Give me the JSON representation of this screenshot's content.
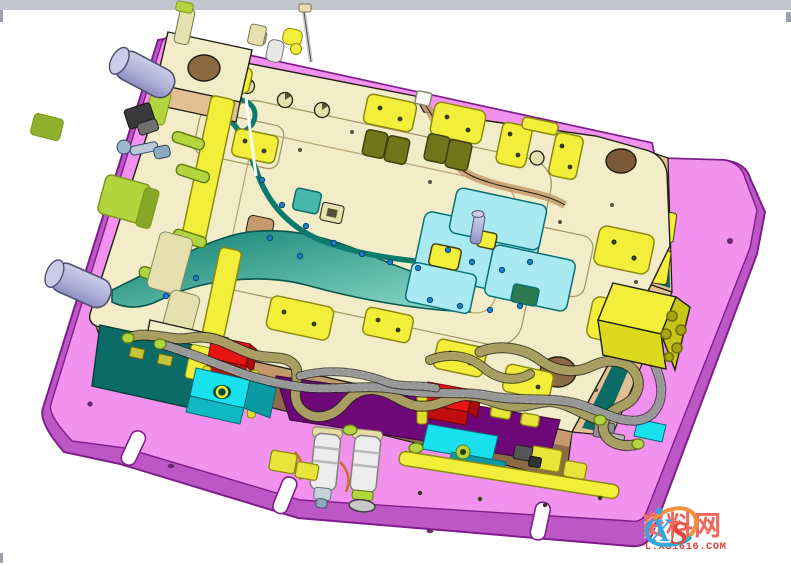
{
  "window": {
    "top_bar_present": true
  },
  "viewport": {
    "type": "3d-cad-view",
    "content": "Plastic injection mold tooling assembly, isometric view",
    "background_color": "#ffffff"
  },
  "watermark": {
    "logo_letter_1": "X",
    "logo_letter_2": "S",
    "site_name": "资料网",
    "site_url": "ZL.XS1616.COM"
  },
  "components": [
    {
      "name": "bottom-clamping-plate",
      "color": "#F292EE"
    },
    {
      "name": "core-plate-top",
      "color": "#F2EDC8"
    },
    {
      "name": "core-plate-front-face",
      "color": "#8C6B46"
    },
    {
      "name": "cavity-surface",
      "color": "#1E8C7A"
    },
    {
      "name": "slider-inserts",
      "color": "#A8E9F2"
    },
    {
      "name": "wear-pads",
      "color": "#F2EE3A"
    },
    {
      "name": "guide-pins",
      "color": "#B4B4DC"
    },
    {
      "name": "limit-blocks",
      "color": "#E81414"
    },
    {
      "name": "cooling-blocks",
      "color": "#18E0EC"
    },
    {
      "name": "cooling-hoses",
      "color": "#E4DCA4"
    },
    {
      "name": "lifting-block",
      "color": "#F2EE3A"
    }
  ],
  "palette": {
    "topBar": "#C3C4CE",
    "nub": "#9DA0AC",
    "outline": "#1E1E14",
    "pinkTop": "#F292EE",
    "pinkBand": "#BE57C6",
    "pinkDark": "#7E1E8A",
    "cream": "#F2EDC8",
    "creamShade": "#E6DFAE",
    "tanLight": "#E3C094",
    "tan": "#C49A6C",
    "brown": "#8C6B46",
    "brownDeep": "#6E5232",
    "tealDark": "#0B6B66",
    "tealBand1": "#0E7F6F",
    "tealBand2": "#8FDCCB",
    "cyanPale": "#A8E9F2",
    "cyanBright": "#18E0EC",
    "cyanMid": "#0A9AA6",
    "chartreuse": "#B2D53E",
    "chartreuseDark": "#7A9A1E",
    "yellow": "#F2EE3A",
    "yellowDeep": "#C9C516",
    "olivePad": "#72741C",
    "oliveDark": "#3F4010",
    "red": "#E81414",
    "redDark": "#A80C0C",
    "purple": "#6E0878",
    "lavender": "#B0B0D8",
    "lavenderLight": "#CCCCEA",
    "steelBlue": "#1F7FD0",
    "hoseCream": "#E4DCA4",
    "hoseCreamShade": "#A89E62",
    "hoseWhite": "#E6E6E6",
    "hoseWhiteShade": "#989898",
    "copper": "#C87028",
    "grayPart": "#8E8E8E",
    "wmRed": "#F0685C",
    "wmRedDeep": "#E04838",
    "wmBlue": "#35A8DC",
    "wmOrange": "#F09040"
  }
}
